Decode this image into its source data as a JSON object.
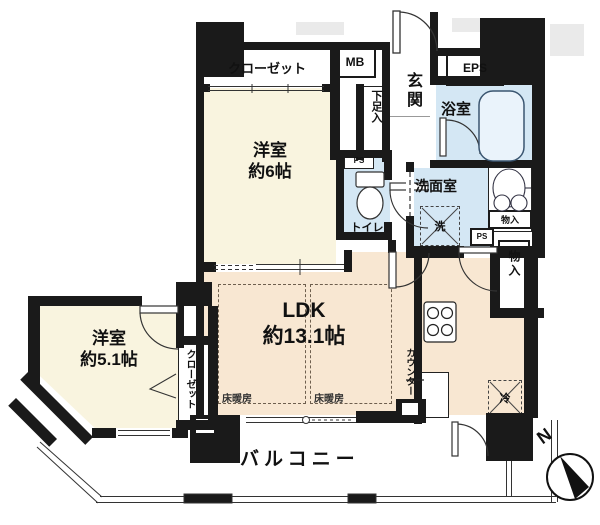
{
  "title": "apartment-floor-plan",
  "colors": {
    "wall": "#1a1a1a",
    "room_cream": "#f9f4df",
    "ldk_peach": "#f8e7d2",
    "wet_blue": "#d4e7f4",
    "tub_outline": "#3a5570",
    "heating_dash": "#6e5f4e"
  },
  "rooms": {
    "closet_main": {
      "label": "クローゼット"
    },
    "mb": {
      "label": "MB"
    },
    "genkan": {
      "label": "玄関"
    },
    "eps": {
      "label": "EPS"
    },
    "bathroom": {
      "label": "浴室"
    },
    "shoe_box": {
      "label": "下足入"
    },
    "bedroom6": {
      "name": "洋室",
      "size": "約6帖"
    },
    "toilet": {
      "label": "トイレ",
      "ps": "PS"
    },
    "washroom": {
      "label": "洗面室",
      "washer": "洗"
    },
    "storage_small": {
      "label": "物入"
    },
    "ps_small": {
      "label": "PS"
    },
    "storage_tall": {
      "label": "物入"
    },
    "bedroom51": {
      "name": "洋室",
      "size": "約5.1帖",
      "closet": "クローゼット"
    },
    "ldk": {
      "name": "LDK",
      "size": "約13.1帖",
      "floor_heating_left": "床暖房",
      "floor_heating_right": "床暖房"
    },
    "kitchen": {
      "counter": "カウンター",
      "fridge": "冷"
    },
    "balcony": {
      "label": "バルコニー"
    }
  },
  "compass": {
    "north": "N"
  }
}
